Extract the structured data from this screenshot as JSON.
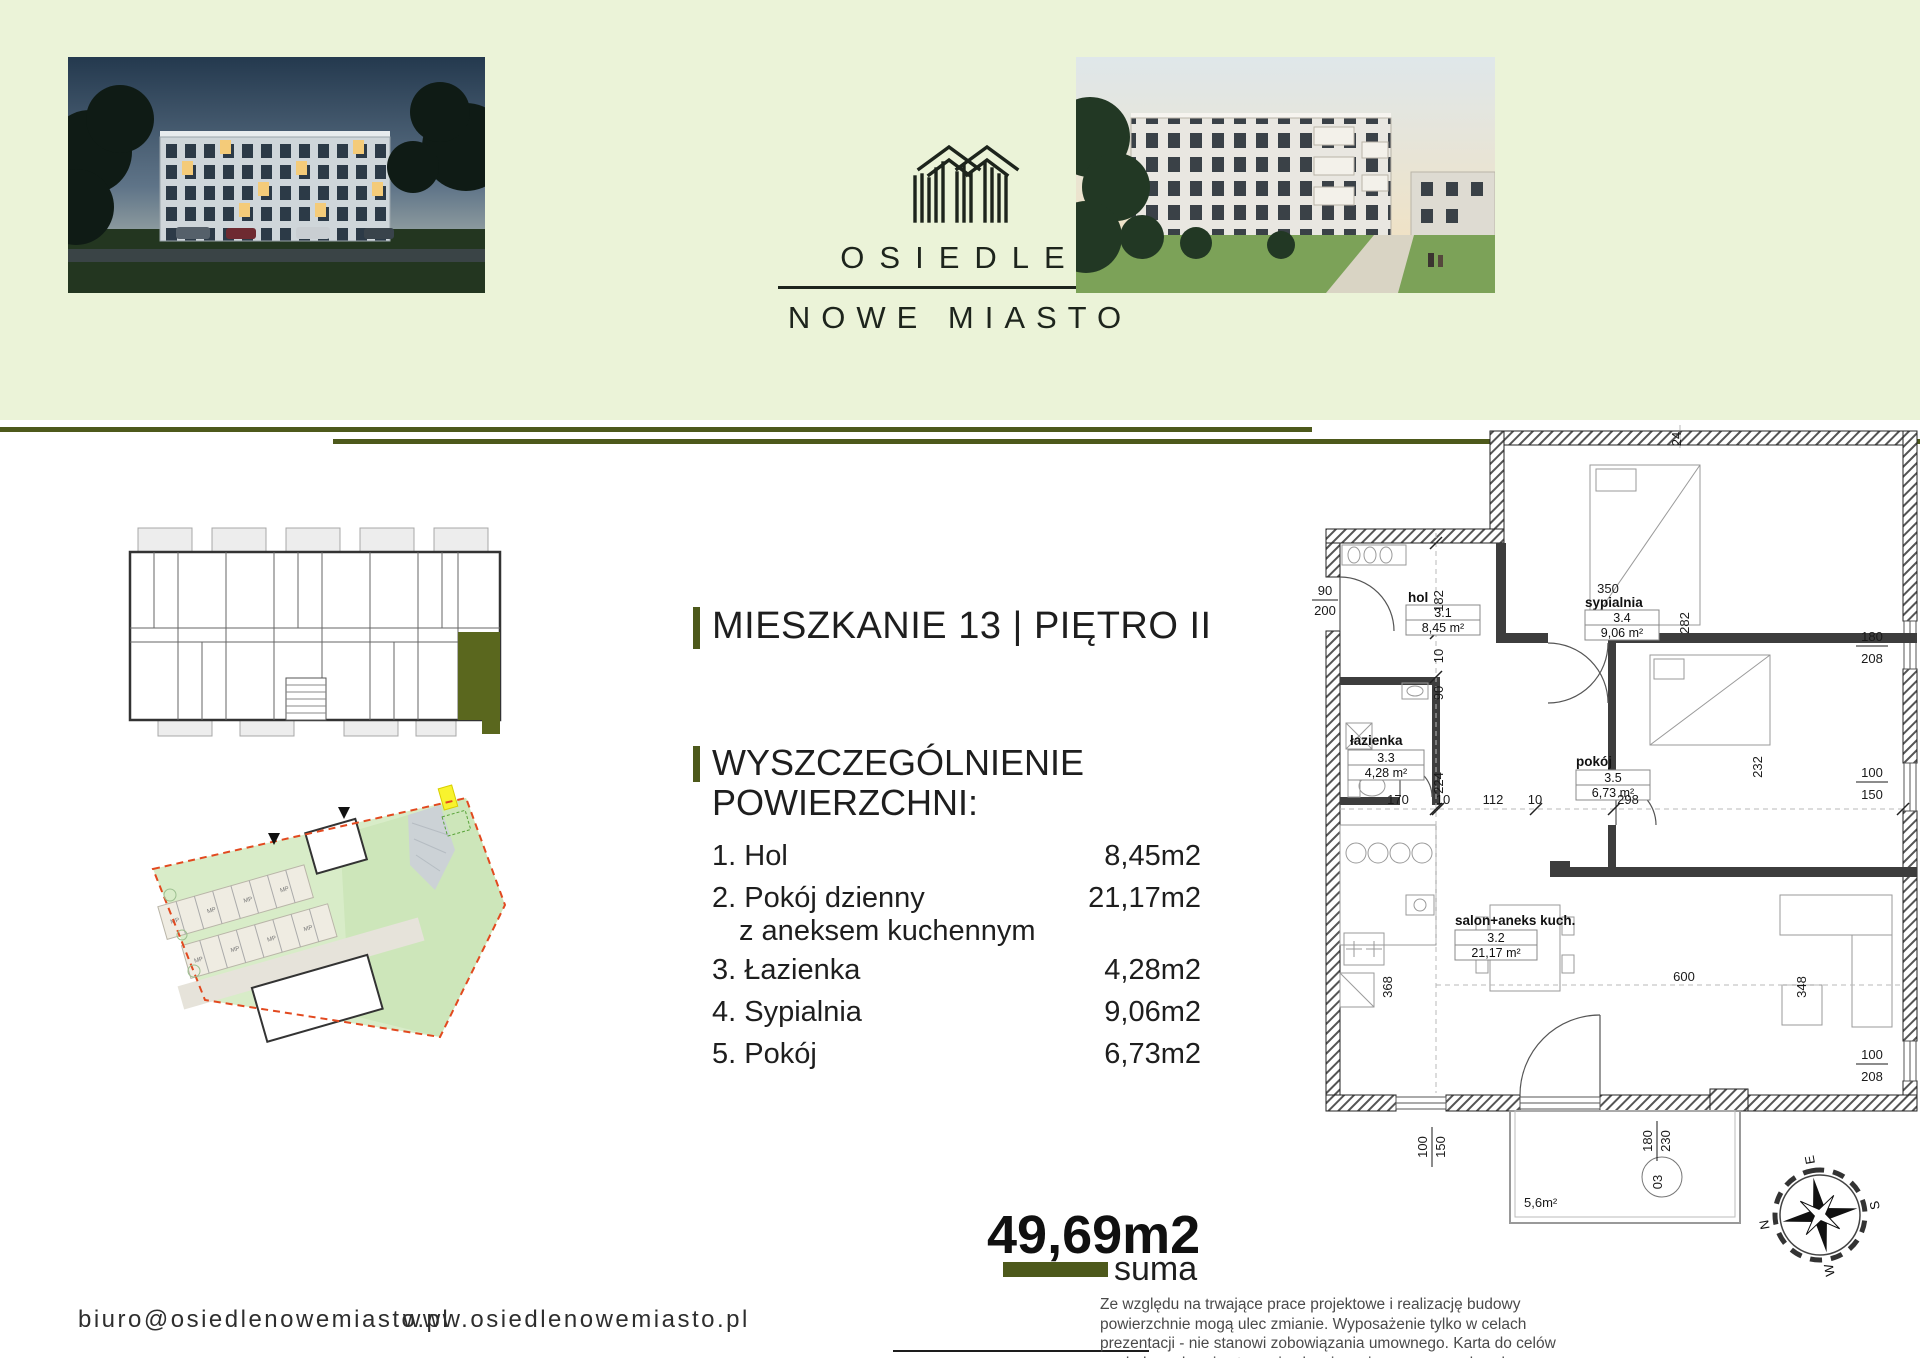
{
  "colors": {
    "accent_olive": "#4d591b",
    "header_bg": "#ebf3d8",
    "highlight_unit": "#5a671e",
    "boundary_red": "#e2491f",
    "marker_yellow": "#f8f32e",
    "text_dark": "#1e1e1e"
  },
  "header": {
    "logo": {
      "line1": "OSIEDLE",
      "line2": "NOWE MIASTO"
    }
  },
  "apartment": {
    "title": "MIESZKANIE 13 | PIĘTRO II",
    "section_line1": "WYSZCZEGÓLNIENIE",
    "section_line2": "POWIERZCHNI:",
    "rooms": [
      {
        "no": "1.",
        "name": "Hol",
        "area": "8,45m2"
      },
      {
        "no": "2.",
        "name": "Pokój dzienny",
        "name2": "z aneksem kuchennym",
        "area": "21,17m2"
      },
      {
        "no": "3.",
        "name": "Łazienka",
        "area": "4,28m2"
      },
      {
        "no": "4.",
        "name": "Sypialnia",
        "area": "9,06m2"
      },
      {
        "no": "5.",
        "name": "Pokój",
        "area": "6,73m2"
      }
    ],
    "total_value": "49,69m2",
    "total_label": "suma"
  },
  "floorplan": {
    "rooms": [
      {
        "name": "hol",
        "no": "3.1",
        "area": "8,45 m²"
      },
      {
        "name": "sypialnia",
        "no": "3.4",
        "area": "9,06 m²"
      },
      {
        "name": "łazienka",
        "no": "3.3",
        "area": "4,28 m²"
      },
      {
        "name": "pokój",
        "no": "3.5",
        "area": "6,73 m²"
      },
      {
        "name": "salon+aneks kuch.",
        "no": "3.2",
        "area": "21,17 m²"
      }
    ],
    "dims": {
      "door": {
        "t": "90",
        "b": "200"
      },
      "w182": "182",
      "v10a": "10",
      "v90": "90",
      "v224": "224",
      "w350": "350",
      "w282": "282",
      "w24": "24",
      "h170": "170",
      "h10b": "10",
      "h112": "112",
      "h10c": "10",
      "h298": "298",
      "v232": "232",
      "v368": "368",
      "h600": "600",
      "v348": "348",
      "win1": {
        "t": "180",
        "b": "208"
      },
      "win2": {
        "t": "100",
        "b": "150"
      },
      "win3": {
        "t": "100",
        "b": "208"
      },
      "bal1": {
        "t": "100",
        "b": "150"
      },
      "bal2": {
        "t": "180",
        "b": "230"
      }
    },
    "balcony": {
      "area": "5,6m²",
      "no": "03"
    },
    "compass": {
      "n": "N",
      "e": "E",
      "s": "S",
      "w": "W"
    }
  },
  "site_plan": {
    "stall_label": "MP"
  },
  "footer": {
    "email": "biuro@osiedlenowemiasto.pl",
    "website": "www.osiedlenowemiasto.pl",
    "disclaimer": "Ze względu na trwające prace projektowe i realizację budowy powierzchnie mogą ulec zmianie. Wyposażenie tylko w celach prezentacji - nie stanowi zobowiązania umownego. Karta do celów poglądowych - nie stanowi zobowiązania umownego dewelopera."
  }
}
